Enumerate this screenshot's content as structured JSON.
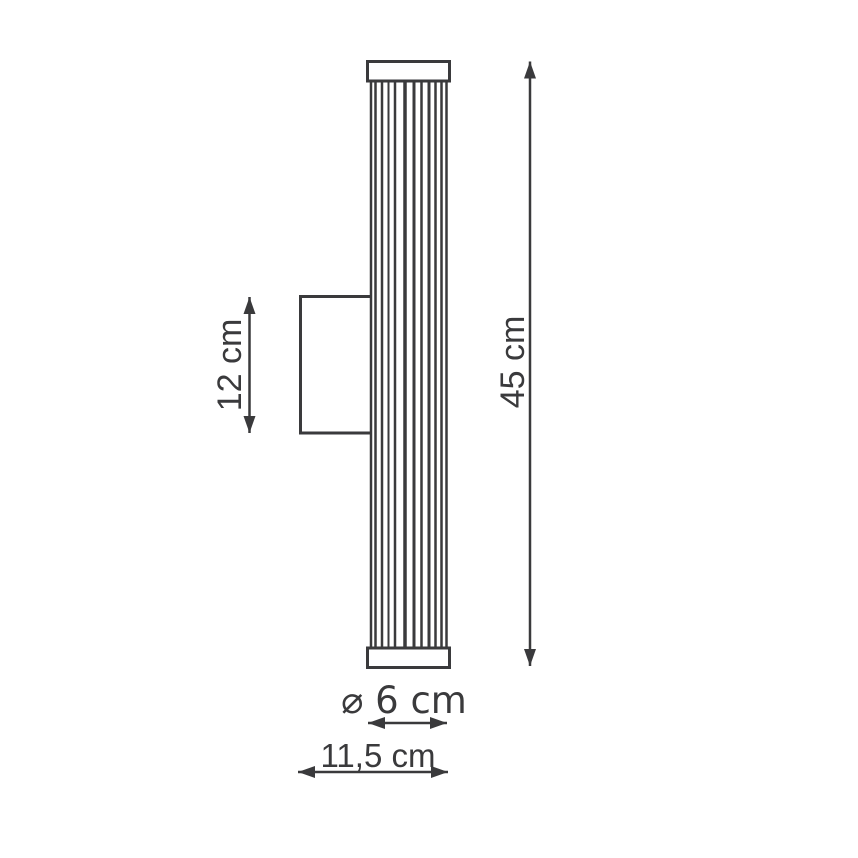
{
  "diagram": {
    "subject": "wall-lamp-dimension-drawing",
    "dimensions": {
      "overall_height_label": "45 cm",
      "bracket_height_label": "12 cm",
      "diameter_label": "⌀ 6 cm",
      "depth_label": "11,5 cm"
    },
    "colors": {
      "line": "#3a3a3c",
      "background": "#ffffff"
    }
  }
}
